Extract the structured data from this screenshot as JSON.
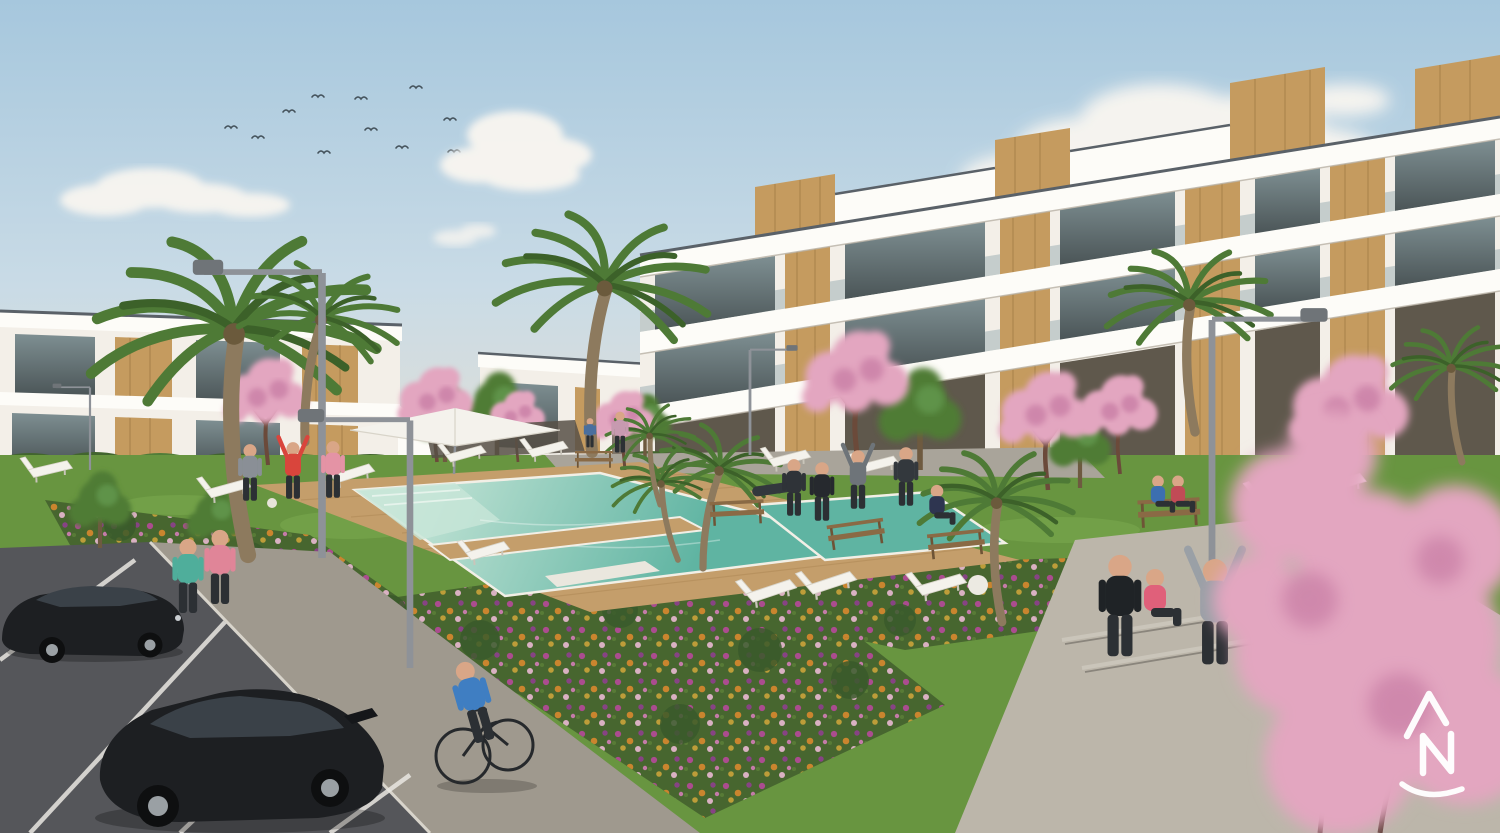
{
  "meta": {
    "type": "architectural-render",
    "subject": "New-build residential complex: white apartment blocks with timber cladding around a landscaped communal garden, swimming pool and parking",
    "width_px": 1500,
    "height_px": 833
  },
  "watermark": {
    "name": "developer-monogram-logo",
    "letters": "AN",
    "color": "#ffffff"
  },
  "palette": {
    "sky_top": "#a6c7dd",
    "sky_mid": "#c9dbe6",
    "sky_horizon": "#e7e0d3",
    "cloud_white": "#f8f5f0",
    "bird_dark": "#45535c",
    "facade_white": "#f3efe8",
    "facade_bright": "#fdfcf8",
    "facade_shadow": "#d4cec2",
    "roof_cap": "#5a6168",
    "glass_light": "#7e8f92",
    "glass_dark": "#4b5557",
    "wood_accent": "#c59b5f",
    "wood_shadow": "#96723e",
    "opening_dark": "#5f584c",
    "hedge_green": "#42652e",
    "hedge_light": "#517d39",
    "tree_green": "#4f7c35",
    "palm_green": "#4e7a36",
    "palm_dark": "#3c6129",
    "palm_trunk": "#8d7a5e",
    "blossom_pink": "#e3a6c0",
    "blossom_deep": "#c97fa6",
    "trunk_brown": "#6b4a3a",
    "grass_green": "#689540",
    "grass_light": "#7fae52",
    "bed_green": "#47662f",
    "bush_dark": "#3a5a2b",
    "deck_wood": "#c49e6b",
    "deck_shadow": "#a37c49",
    "pool_shallow": "#c8e6d8",
    "pool_deep": "#5fb4a2",
    "pool_edge": "#f2efe6",
    "flower_magenta": "#b6499a",
    "flower_orange": "#d9882e",
    "flower_purple": "#8e3f8e",
    "flower_gold": "#caa33a",
    "path_sunlit": "#bcb6aa",
    "path_gray": "#9f998e",
    "asphalt_dark": "#55565a",
    "parking_line": "#e9e7e2",
    "curb_light": "#d8d4cb",
    "car_black": "#1d1f22",
    "car_glass": "#3a4148",
    "lamp_gray": "#8e9298",
    "furniture_white": "#f4f2ec",
    "bench_wood": "#8a6a45",
    "skin": "#d9a687"
  },
  "people": [
    {
      "role": "jogger",
      "shirt": "#4fae9b"
    },
    {
      "role": "jogger",
      "shirt": "#e08598"
    },
    {
      "role": "cyclist",
      "shirt": "#3f7ec2"
    },
    {
      "role": "ball-player",
      "shirt": "#8a8f96"
    },
    {
      "role": "ball-player-kicking",
      "shirt": "#d9453c"
    },
    {
      "role": "ball-player",
      "shirt": "#e493a5"
    },
    {
      "role": "walker",
      "shirt": "#c79ab0"
    },
    {
      "role": "child-walker",
      "shirt": "#4a6f9e"
    },
    {
      "role": "sunbather-on-lounger",
      "shirt": "#33383d"
    },
    {
      "role": "exerciser",
      "shirt": "#2f3338"
    },
    {
      "role": "exerciser-tracksuit",
      "shirt": "#26292e"
    },
    {
      "role": "exerciser-stretching",
      "shirt": "#6e7479"
    },
    {
      "role": "exerciser",
      "shirt": "#33383d"
    },
    {
      "role": "yoga-sitter",
      "shirt": "#2e3550"
    },
    {
      "role": "stretcher",
      "shirt": "#1f2326"
    },
    {
      "role": "path-sitter",
      "shirt": "#e0607a"
    },
    {
      "role": "stretcher-arms-up",
      "shirt": "#9aa0a6"
    },
    {
      "role": "bench-sitter",
      "shirt": "#3c6fb0"
    },
    {
      "role": "bench-sitter",
      "shirt": "#c14b56"
    }
  ],
  "scene": {
    "sky": "Clear blue sky with scattered white clouds and a flock of birds",
    "buildings": {
      "left_block": "Two-storey white apartments with timber panels and external stair",
      "right_block": "Three-storey stepped white apartment block with rooftop timber volumes, glass balconies and timber feature columns"
    },
    "amenities": [
      "communal swimming pool with timber deck",
      "white sun loungers",
      "white parasol",
      "garden benches",
      "street lamps"
    ],
    "landscape": [
      "palm trees",
      "pink blossom trees",
      "flower beds",
      "lawns",
      "hedges"
    ],
    "vehicles": [
      "black saloon car",
      "black hatchback car"
    ],
    "ground": [
      "parking bays with white lines",
      "paved walkways"
    ]
  }
}
